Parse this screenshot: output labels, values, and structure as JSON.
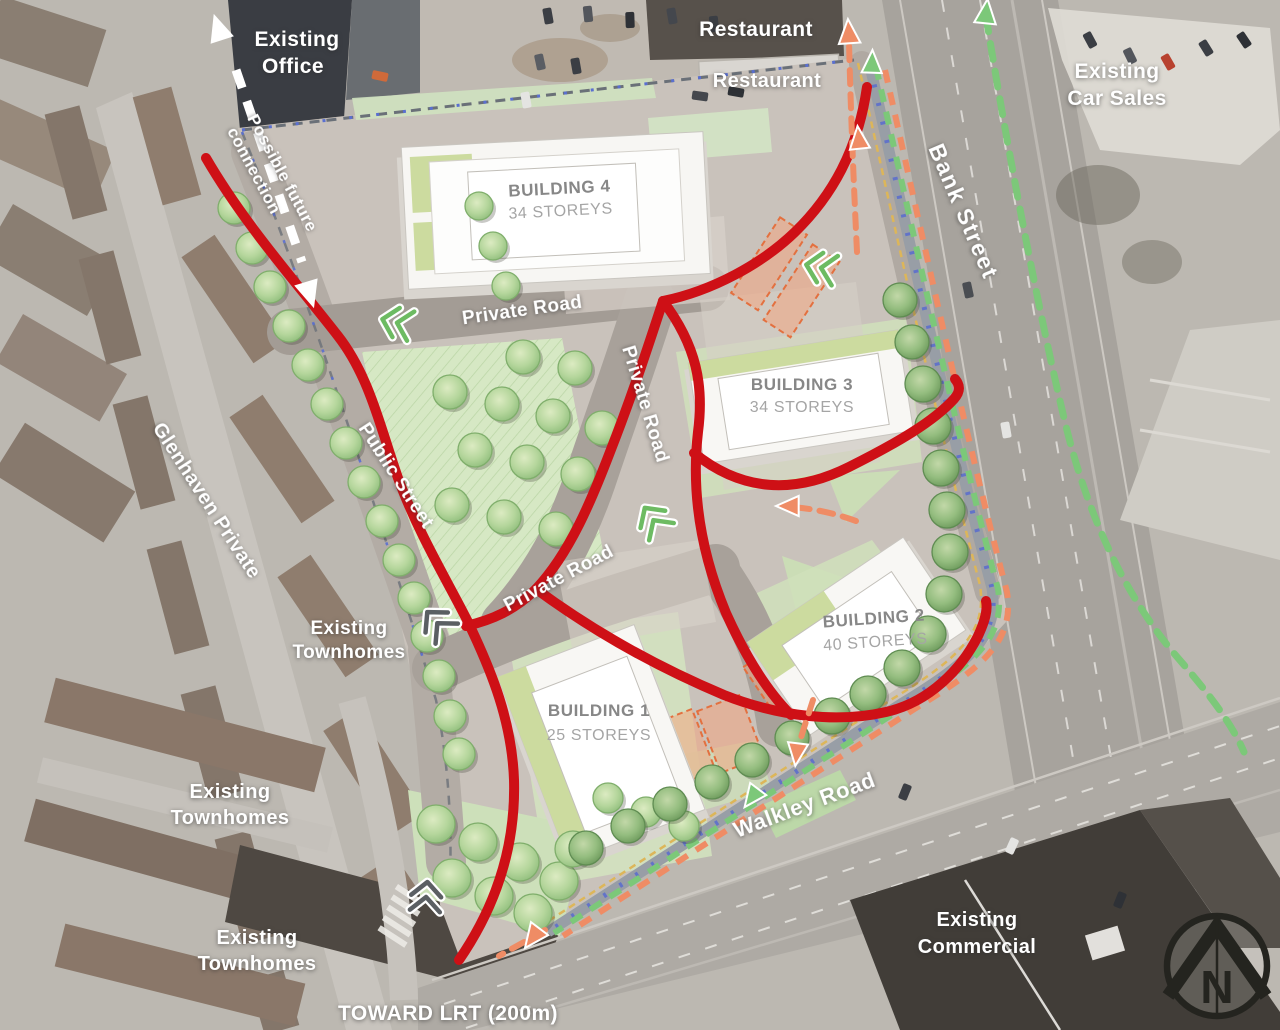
{
  "labels": {
    "existing_office": {
      "l1": "Existing",
      "l2": "Office"
    },
    "possible_future_connection": {
      "l1": "Possible future",
      "l2": "connection"
    },
    "restaurant_top": "Restaurant",
    "restaurant_lower": "Restaurant",
    "existing_car_sales": {
      "l1": "Existing",
      "l2": "Car Sales"
    },
    "bank_street": "Bank Street",
    "building4": {
      "name": "BUILDING 4",
      "storeys": "34 STOREYS"
    },
    "building3": {
      "name": "BUILDING 3",
      "storeys": "34 STOREYS"
    },
    "building2": {
      "name": "BUILDING 2",
      "storeys": "40 STOREYS"
    },
    "building1": {
      "name": "BUILDING 1",
      "storeys": "25 STOREYS"
    },
    "private_road_north": "Private Road",
    "private_road_central": "Private Road",
    "private_road_south": "Private Road",
    "public_street": "Public Street",
    "glenhaven_private": "Glenhaven Private",
    "existing_townhomes_mid": {
      "l1": "Existing",
      "l2": "Townhomes"
    },
    "existing_townhomes_west": {
      "l1": "Existing",
      "l2": "Townhomes"
    },
    "existing_townhomes_south": {
      "l1": "Existing",
      "l2": "Townhomes"
    },
    "walkley_road": "Walkley Road",
    "existing_commercial": {
      "l1": "Existing",
      "l2": "Commercial"
    },
    "toward_lrt": "TOWARD LRT (200m)",
    "compass_n": "N"
  },
  "colors": {
    "red_route": "#ce1016",
    "orange_route": "#ef8c65",
    "green_route": "#7cc879",
    "white_route": "#ffffff",
    "band_gray": "#989ea6",
    "band_blue": "#6273c8",
    "band_yellow": "#ddb659",
    "boundary": "#6a7078",
    "boundary_blue": "#5a6fd0"
  },
  "map": {
    "red_routes": [
      {
        "d": "M206,158 C245,225 296,282 338,336 C370,377 381,430 398,478 C418,533 448,582 468,622 C492,672 512,722 514,780 C516,852 492,912 459,960"
      },
      {
        "d": "M867,87 C858,150 832,196 795,232 C762,264 712,291 663,301"
      },
      {
        "d": "M663,301 C645,356 630,401 610,452 C592,499 570,553 536,589 C515,610 492,620 466,626"
      },
      {
        "d": "M536,589 C600,636 662,669 724,695 C780,717 838,723 886,712 C930,702 962,668 978,636 C985,621 988,610 986,601"
      },
      {
        "d": "M663,301 C697,346 704,386 698,432 C691,493 701,553 726,613 C744,653 765,689 791,715"
      },
      {
        "d": "M694,453 C741,491 793,495 849,467 C899,442 934,421 954,399 C961,391 960,385 955,379"
      }
    ],
    "orange_routes": [
      {
        "d": "M857,252 C854,190 851,120 849,42"
      },
      {
        "d": "M856,521 C834,513 815,509 792,507"
      },
      {
        "d": "M813,700 C808,716 802,733 798,748"
      },
      {
        "d": "M545,930 C528,940 513,948 499,956"
      }
    ],
    "green_routes": [
      {
        "d": "M986,16 C1004,130 1036,300 1064,418 C1088,520 1128,600 1178,658 C1210,695 1232,724 1244,752"
      }
    ],
    "band": {
      "base": "M870,66 C903,212 950,430 992,588 C999,634 974,660 901,704 L548,932"
    },
    "white_connection": {
      "d": "M236,70 L302,262"
    },
    "arrows": [
      {
        "x": 219,
        "y": 30,
        "rot": -18,
        "c": "white",
        "s": 17
      },
      {
        "x": 309,
        "y": 292,
        "rot": 163,
        "c": "white",
        "s": 17
      },
      {
        "x": 849,
        "y": 34,
        "rot": -4,
        "c": "orange",
        "s": 15
      },
      {
        "x": 859,
        "y": 140,
        "rot": -6,
        "c": "orange",
        "s": 14
      },
      {
        "x": 790,
        "y": 506,
        "rot": 270,
        "c": "orange",
        "s": 14
      },
      {
        "x": 797,
        "y": 752,
        "rot": 187,
        "c": "orange",
        "s": 14
      },
      {
        "x": 534,
        "y": 936,
        "rot": 217,
        "c": "orange",
        "s": 15
      },
      {
        "x": 986,
        "y": 14,
        "rot": 6,
        "c": "green",
        "s": 15
      },
      {
        "x": 872,
        "y": 64,
        "rot": 2,
        "c": "green",
        "s": 14
      },
      {
        "x": 753,
        "y": 796,
        "rot": 217,
        "c": "green",
        "s": 14
      }
    ],
    "chevrons": [
      {
        "x": 398,
        "y": 323,
        "rot": 14,
        "c": "green"
      },
      {
        "x": 822,
        "y": 268,
        "rot": 12,
        "c": "green"
      },
      {
        "x": 654,
        "y": 521,
        "rot": 55,
        "c": "green"
      },
      {
        "x": 438,
        "y": 624,
        "rot": 48,
        "c": "gray"
      },
      {
        "x": 426,
        "y": 898,
        "rot": 95,
        "c": "gray"
      }
    ],
    "trees": [
      [
        234,
        208,
        16,
        0
      ],
      [
        252,
        248,
        16,
        0
      ],
      [
        270,
        287,
        16,
        0
      ],
      [
        289,
        326,
        16,
        0
      ],
      [
        308,
        365,
        16,
        0
      ],
      [
        327,
        404,
        16,
        0
      ],
      [
        346,
        443,
        16,
        0
      ],
      [
        364,
        482,
        16,
        0
      ],
      [
        382,
        521,
        16,
        0
      ],
      [
        399,
        560,
        16,
        0
      ],
      [
        414,
        598,
        16,
        0
      ],
      [
        427,
        636,
        16,
        0
      ],
      [
        439,
        676,
        16,
        0
      ],
      [
        450,
        716,
        16,
        0
      ],
      [
        459,
        754,
        16,
        0
      ],
      [
        479,
        206,
        14,
        0
      ],
      [
        493,
        246,
        14,
        0
      ],
      [
        506,
        286,
        14,
        0
      ],
      [
        523,
        357,
        17,
        0
      ],
      [
        575,
        368,
        17,
        0
      ],
      [
        450,
        392,
        17,
        0
      ],
      [
        502,
        404,
        17,
        0
      ],
      [
        553,
        416,
        17,
        0
      ],
      [
        602,
        428,
        17,
        0
      ],
      [
        475,
        450,
        17,
        0
      ],
      [
        527,
        462,
        17,
        0
      ],
      [
        578,
        474,
        17,
        0
      ],
      [
        452,
        505,
        17,
        0
      ],
      [
        504,
        517,
        17,
        0
      ],
      [
        556,
        529,
        17,
        0
      ],
      [
        436,
        824,
        19,
        0
      ],
      [
        478,
        842,
        19,
        0
      ],
      [
        520,
        862,
        19,
        0
      ],
      [
        559,
        881,
        19,
        0
      ],
      [
        452,
        878,
        19,
        0
      ],
      [
        494,
        896,
        19,
        0
      ],
      [
        533,
        913,
        19,
        0
      ],
      [
        573,
        849,
        18,
        0
      ],
      [
        608,
        798,
        15,
        0
      ],
      [
        646,
        812,
        15,
        0
      ],
      [
        684,
        826,
        15,
        0
      ],
      [
        900,
        300,
        17,
        1
      ],
      [
        912,
        342,
        17,
        1
      ],
      [
        923,
        384,
        18,
        1
      ],
      [
        933,
        426,
        18,
        1
      ],
      [
        941,
        468,
        18,
        1
      ],
      [
        947,
        510,
        18,
        1
      ],
      [
        950,
        552,
        18,
        1
      ],
      [
        944,
        594,
        18,
        1
      ],
      [
        928,
        634,
        18,
        1
      ],
      [
        902,
        668,
        18,
        1
      ],
      [
        868,
        694,
        18,
        1
      ],
      [
        832,
        716,
        18,
        1
      ],
      [
        792,
        738,
        17,
        1
      ],
      [
        752,
        760,
        17,
        1
      ],
      [
        712,
        782,
        17,
        1
      ],
      [
        670,
        804,
        17,
        1
      ],
      [
        628,
        826,
        17,
        1
      ],
      [
        586,
        848,
        17,
        1
      ]
    ],
    "cars": [
      [
        548,
        16,
        80,
        "#3b3e44"
      ],
      [
        588,
        14,
        84,
        "#53565c"
      ],
      [
        630,
        20,
        88,
        "#2e3136"
      ],
      [
        672,
        16,
        80,
        "#44474d"
      ],
      [
        714,
        24,
        84,
        "#3b3e44"
      ],
      [
        540,
        62,
        78,
        "#5a5d63"
      ],
      [
        576,
        66,
        80,
        "#3b3e44"
      ],
      [
        700,
        96,
        8,
        "#44474d"
      ],
      [
        736,
        92,
        10,
        "#2e3136"
      ],
      [
        380,
        76,
        12,
        "#cf6a3a"
      ],
      [
        526,
        100,
        80,
        "#e4e4e2"
      ],
      [
        1090,
        40,
        62,
        "#3b3e44"
      ],
      [
        1130,
        56,
        64,
        "#53565c"
      ],
      [
        1168,
        62,
        60,
        "#b8422f"
      ],
      [
        1206,
        48,
        58,
        "#3b3e44"
      ],
      [
        1244,
        40,
        56,
        "#2e3136"
      ],
      [
        968,
        290,
        78,
        "#4a4d52"
      ],
      [
        1006,
        430,
        80,
        "#e4e4e2"
      ],
      [
        905,
        792,
        112,
        "#3b3e44"
      ],
      [
        1012,
        846,
        114,
        "#e4e4e2"
      ],
      [
        1120,
        900,
        112,
        "#2e3136"
      ]
    ]
  }
}
